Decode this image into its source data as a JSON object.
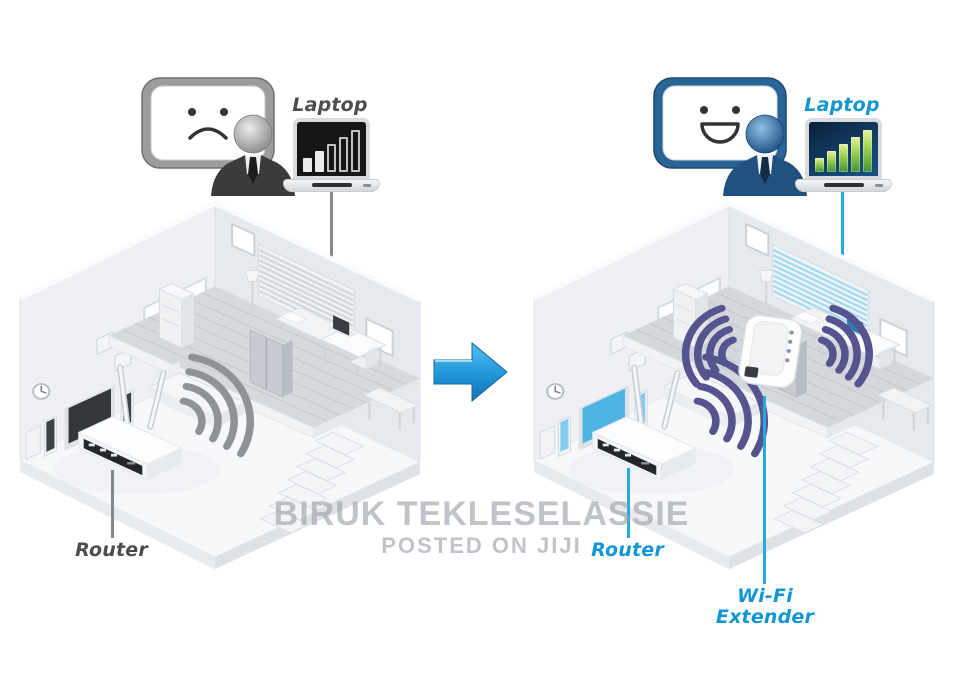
{
  "watermark": {
    "line1": "BIRUK TEKLESELASSIE",
    "line2": "POSTED ON JIJI"
  },
  "before": {
    "laptop_label": "Laptop",
    "router_label": "Router",
    "mood": "sad",
    "signal": {
      "filled": 2,
      "total": 5
    }
  },
  "after": {
    "laptop_label": "Laptop",
    "router_label": "Router",
    "extender_label_line1": "Wi-Fi",
    "extender_label_line2": "Extender",
    "mood": "happy",
    "signal": {
      "filled": 5,
      "total": 5
    }
  },
  "arrow": {
    "direction": "right"
  },
  "colors": {
    "label_dark": "#4d4d4d",
    "label_blue": "#1296d4",
    "leader_gray": "#85888b",
    "leader_cyan": "#29a8e0",
    "arc_gray": "#8f9296",
    "arc_purple": "#56548e",
    "arrow_blue": "#2196d9",
    "signal_green": "#5aa33c",
    "watermark_gray": "#9aa0a6"
  }
}
